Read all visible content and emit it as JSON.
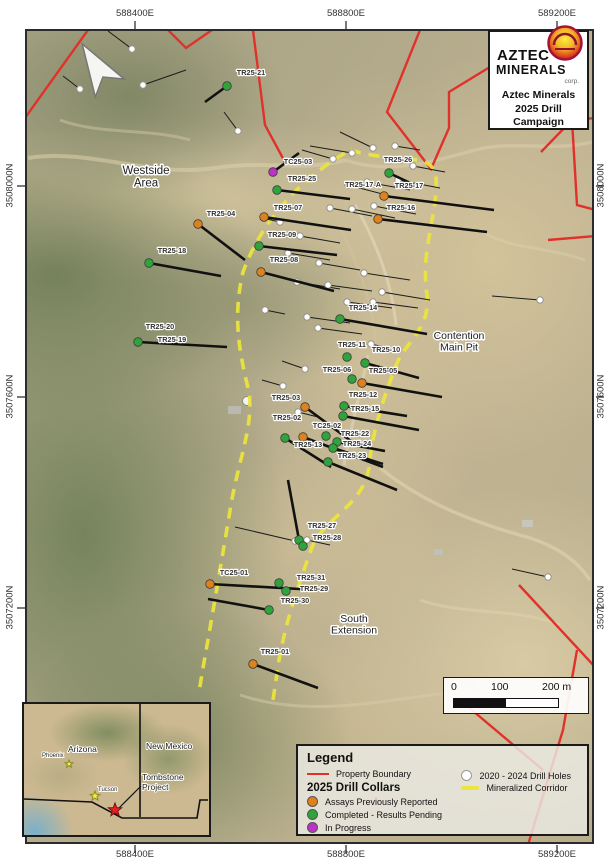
{
  "map_frame": {
    "coords_top": [
      "588400E",
      "588800E",
      "589200E"
    ],
    "coords_bottom": [
      "588400E",
      "588800E",
      "589200E"
    ],
    "coords_left": [
      "3508000N",
      "3507600N",
      "3507200N"
    ],
    "coords_right": [
      "3508000N",
      "3507600N",
      "3507200N"
    ]
  },
  "title_box": {
    "brand_top": "AZTEC",
    "brand_bottom": "MINERALS",
    "brand_corp": "corp.",
    "campaign_lines": [
      "Aztec Minerals",
      "2025 Drill",
      "Campaign"
    ]
  },
  "scale_bar": {
    "tick0": "0",
    "tick100": "100",
    "tick200": "200 m"
  },
  "legend": {
    "title": "Legend",
    "property_boundary": "Property Boundary",
    "drill_collars_header": "2025 Drill Collars",
    "assays": "Assays Previously Reported",
    "completed": "Completed - Results Pending",
    "in_progress": "In Progress",
    "holes_2020": "2020 - 2024 Drill Holes",
    "corridor": "Mineralized Corridor"
  },
  "colors": {
    "boundary": "#e0322a",
    "corridor": "#ece53c",
    "reported": "#e0821c",
    "completed": "#2da43c",
    "in_progress": "#bc31c8",
    "hole_2020": "#ffffff"
  },
  "map_labels": [
    {
      "lines": [
        "Westside",
        "Area"
      ],
      "x": 146,
      "y": 174,
      "size": 11.5
    },
    {
      "lines": [
        "Contention",
        "Main Pit"
      ],
      "x": 459,
      "y": 339,
      "size": 10.5
    },
    {
      "lines": [
        "South",
        "Extension"
      ],
      "x": 354,
      "y": 622,
      "size": 10.5
    }
  ],
  "map_geometry": {
    "property_boundary": [
      [
        [
          25,
          118
        ],
        [
          88,
          30
        ]
      ],
      [
        [
          168,
          30
        ],
        [
          186,
          48
        ],
        [
          212,
          30
        ]
      ],
      [
        [
          253,
          30
        ],
        [
          265,
          125
        ],
        [
          285,
          162
        ]
      ],
      [
        [
          420,
          30
        ],
        [
          387,
          112
        ],
        [
          431,
          169
        ],
        [
          449,
          128
        ],
        [
          449,
          92
        ],
        [
          521,
          48
        ],
        [
          549,
          30
        ]
      ],
      [
        [
          596,
          118
        ],
        [
          572,
          120
        ],
        [
          541,
          152
        ]
      ],
      [
        [
          572,
          120
        ],
        [
          577,
          205
        ],
        [
          596,
          210
        ]
      ],
      [
        [
          548,
          240
        ],
        [
          596,
          236
        ]
      ],
      [
        [
          519,
          585
        ],
        [
          596,
          668
        ]
      ],
      [
        [
          577,
          650
        ],
        [
          563,
          730
        ],
        [
          528,
          845
        ]
      ],
      [
        [
          460,
          700
        ],
        [
          543,
          770
        ]
      ]
    ],
    "corridor_paths": [
      "M345,153 C300,180 262,220 243,272 C232,318 240,355 249,392 C254,425 238,462 231,505 C222,558 213,612 203,668 L199,692",
      "M350,150 C400,165 433,150 436,178 C438,215 420,250 427,295 C431,330 404,342 395,368 C385,395 372,430 369,468 C362,508 322,518 311,550 C296,592 286,622 279,660 L273,700"
    ]
  },
  "collars_2025": [
    {
      "id": "TC25-03",
      "status": "in_progress",
      "x": 273,
      "y": 172,
      "lx": 298,
      "ly": 164,
      "tx": 299,
      "ty": 153
    },
    {
      "id": "TR25-25",
      "status": "completed",
      "x": 277,
      "y": 190,
      "lx": 302,
      "ly": 181,
      "tx": 350,
      "ty": 199
    },
    {
      "id": "TR25-26",
      "status": "completed",
      "x": 389,
      "y": 173,
      "lx": 398,
      "ly": 162,
      "tx": 421,
      "ty": 188
    },
    {
      "id": "TR25-17-A",
      "status": "reported",
      "x": null,
      "y": null,
      "lx": 363,
      "ly": 187,
      "tx": null,
      "ty": null
    },
    {
      "id": "TR25-17",
      "status": "reported",
      "x": 384,
      "y": 196,
      "lx": 409,
      "ly": 188,
      "tx": 494,
      "ty": 210
    },
    {
      "id": "TR25-16",
      "status": "reported",
      "x": 378,
      "y": 219,
      "lx": 401,
      "ly": 210,
      "tx": 487,
      "ty": 232
    },
    {
      "id": "TR25-04",
      "status": "reported",
      "x": 198,
      "y": 224,
      "lx": 221,
      "ly": 216,
      "tx": 245,
      "ty": 260
    },
    {
      "id": "TR25-07",
      "status": "reported",
      "x": 264,
      "y": 217,
      "lx": 288,
      "ly": 210,
      "tx": 351,
      "ty": 230
    },
    {
      "id": "TR25-09",
      "status": "completed",
      "x": 259,
      "y": 246,
      "lx": 282,
      "ly": 237,
      "tx": 337,
      "ty": 255
    },
    {
      "id": "TR25-18",
      "status": "completed",
      "x": 149,
      "y": 263,
      "lx": 172,
      "ly": 253,
      "tx": 221,
      "ty": 276
    },
    {
      "id": "TR25-08",
      "status": "reported",
      "x": 261,
      "y": 272,
      "lx": 284,
      "ly": 262,
      "tx": 334,
      "ty": 291
    },
    {
      "id": "TR25-21",
      "status": "completed",
      "x": 227,
      "y": 86,
      "lx": 251,
      "ly": 75,
      "tx": 205,
      "ty": 102
    },
    {
      "id": "TR25-20",
      "status": "completed",
      "x": 138,
      "y": 342,
      "lx": 160,
      "ly": 329,
      "tx": 227,
      "ty": 347
    },
    {
      "id": "TR25-19",
      "status": "completed",
      "x": null,
      "y": null,
      "lx": 172,
      "ly": 342,
      "tx": null,
      "ty": null
    },
    {
      "id": "TR25-14",
      "status": "completed",
      "x": 340,
      "y": 319,
      "lx": 363,
      "ly": 310,
      "tx": 427,
      "ty": 334
    },
    {
      "id": "TR25-11",
      "status": "completed",
      "x": 347,
      "y": 357,
      "lx": 352,
      "ly": 347,
      "tx": null,
      "ty": null
    },
    {
      "id": "TR25-10",
      "status": "completed",
      "x": 365,
      "y": 363,
      "lx": 386,
      "ly": 352,
      "tx": 419,
      "ty": 378
    },
    {
      "id": "TR25-06",
      "status": "completed",
      "x": 352,
      "y": 379,
      "lx": 337,
      "ly": 372,
      "tx": null,
      "ty": null
    },
    {
      "id": "TR25-05",
      "status": "reported",
      "x": 362,
      "y": 383,
      "lx": 383,
      "ly": 373,
      "tx": 442,
      "ty": 397
    },
    {
      "id": "TR25-12",
      "status": "completed",
      "x": 344,
      "y": 406,
      "lx": 363,
      "ly": 397,
      "tx": 407,
      "ty": 416
    },
    {
      "id": "TR25-15",
      "status": "completed",
      "x": 343,
      "y": 416,
      "lx": 365,
      "ly": 411,
      "tx": 419,
      "ty": 430
    },
    {
      "id": "TR25-03",
      "status": "reported",
      "x": 305,
      "y": 407,
      "lx": 286,
      "ly": 400,
      "tx": 355,
      "ty": 444
    },
    {
      "id": "TR25-02",
      "status": "reported",
      "x": 303,
      "y": 437,
      "lx": 287,
      "ly": 420,
      "tx": 383,
      "ty": 467
    },
    {
      "id": "TC25-02",
      "status": "completed",
      "x": 326,
      "y": 436,
      "lx": 327,
      "ly": 428,
      "tx": null,
      "ty": null
    },
    {
      "id": "TR25-22",
      "status": "completed",
      "x": 337,
      "y": 442,
      "lx": 355,
      "ly": 436,
      "tx": 385,
      "ty": 451
    },
    {
      "id": "TR25-24",
      "status": "completed",
      "x": 333,
      "y": 448,
      "lx": 357,
      "ly": 446,
      "tx": 383,
      "ty": 464
    },
    {
      "id": "TR25-13",
      "status": "completed",
      "x": 285,
      "y": 438,
      "lx": 308,
      "ly": 447,
      "tx": 331,
      "ty": 467
    },
    {
      "id": "TR25-23",
      "status": "completed",
      "x": 328,
      "y": 462,
      "lx": 352,
      "ly": 458,
      "tx": 397,
      "ty": 490
    },
    {
      "id": "TR25-27",
      "status": "completed",
      "x": 299,
      "y": 540,
      "lx": 322,
      "ly": 528,
      "tx": 288,
      "ty": 480
    },
    {
      "id": "TR25-28",
      "status": "completed",
      "x": 303,
      "y": 546,
      "lx": 327,
      "ly": 540,
      "tx": null,
      "ty": null
    },
    {
      "id": "TC25-01",
      "status": "reported",
      "x": 210,
      "y": 584,
      "lx": 234,
      "ly": 575,
      "tx": 317,
      "ty": 590
    },
    {
      "id": "TR25-31",
      "status": "completed",
      "x": 279,
      "y": 583,
      "lx": 311,
      "ly": 580,
      "tx": null,
      "ty": null
    },
    {
      "id": "TR25-29",
      "status": "completed",
      "x": 286,
      "y": 591,
      "lx": 314,
      "ly": 591,
      "tx": null,
      "ty": null
    },
    {
      "id": "TR25-30",
      "status": "completed",
      "x": 269,
      "y": 610,
      "lx": 295,
      "ly": 603,
      "tx": 208,
      "ty": 599
    },
    {
      "id": "TR25-01",
      "status": "reported",
      "x": 253,
      "y": 664,
      "lx": 275,
      "ly": 654,
      "tx": 318,
      "ty": 688
    }
  ],
  "holes_2020_2024": [
    [
      132,
      49,
      108,
      31
    ],
    [
      80,
      89,
      63,
      76
    ],
    [
      143,
      85,
      186,
      70
    ],
    [
      238,
      131,
      224,
      112
    ],
    [
      333,
      159,
      302,
      150
    ],
    [
      352,
      153,
      310,
      146
    ],
    [
      373,
      148,
      340,
      132
    ],
    [
      395,
      146,
      420,
      150
    ],
    [
      348,
      185,
      390,
      196
    ],
    [
      367,
      182,
      410,
      190
    ],
    [
      398,
      180,
      440,
      188
    ],
    [
      413,
      166,
      445,
      172
    ],
    [
      330,
      208,
      372,
      216
    ],
    [
      352,
      209,
      395,
      218
    ],
    [
      374,
      206,
      416,
      214
    ],
    [
      280,
      222,
      262,
      218
    ],
    [
      300,
      236,
      340,
      243
    ],
    [
      288,
      253,
      330,
      260
    ],
    [
      319,
      263,
      360,
      270
    ],
    [
      297,
      282,
      340,
      289
    ],
    [
      328,
      285,
      372,
      291
    ],
    [
      364,
      273,
      410,
      280
    ],
    [
      382,
      292,
      430,
      300
    ],
    [
      307,
      317,
      350,
      323
    ],
    [
      318,
      328,
      362,
      334
    ],
    [
      347,
      302,
      392,
      308
    ],
    [
      373,
      302,
      418,
      308
    ],
    [
      265,
      310,
      285,
      314
    ],
    [
      305,
      369,
      282,
      361
    ],
    [
      371,
      344,
      392,
      349
    ],
    [
      298,
      412,
      318,
      417
    ],
    [
      283,
      386,
      262,
      380
    ],
    [
      295,
      541,
      235,
      527
    ],
    [
      307,
      540,
      330,
      545
    ],
    [
      540,
      300,
      492,
      296
    ],
    [
      548,
      577,
      512,
      569
    ]
  ],
  "inset": {
    "labels": [
      {
        "text": "Phoenix",
        "x": 18,
        "y": 53,
        "size": 6
      },
      {
        "text": "Arizona",
        "x": 44,
        "y": 48,
        "size": 8.5
      },
      {
        "text": "New Mexico",
        "x": 122,
        "y": 45,
        "size": 8.5
      },
      {
        "text": "Tucson",
        "x": 74,
        "y": 87,
        "size": 6
      },
      {
        "text": "Tombstone",
        "x": 118,
        "y": 76,
        "size": 8.5
      },
      {
        "text": "Project",
        "x": 118,
        "y": 86,
        "size": 8.5
      }
    ],
    "borders": [
      [
        [
          116,
          0
        ],
        [
          116,
          113
        ]
      ],
      [
        [
          0,
          95
        ],
        [
          68,
          98
        ],
        [
          98,
          114
        ],
        [
          173,
          114
        ],
        [
          176,
          96
        ],
        [
          189,
          96
        ]
      ]
    ],
    "stars": [
      {
        "type": "city",
        "x": 45,
        "y": 60,
        "r": 4
      },
      {
        "type": "city",
        "x": 71,
        "y": 92,
        "r": 5
      },
      {
        "type": "project",
        "x": 91,
        "y": 106,
        "r": 7
      }
    ],
    "leader": [
      [
        117,
        82
      ],
      [
        95,
        104
      ]
    ]
  }
}
